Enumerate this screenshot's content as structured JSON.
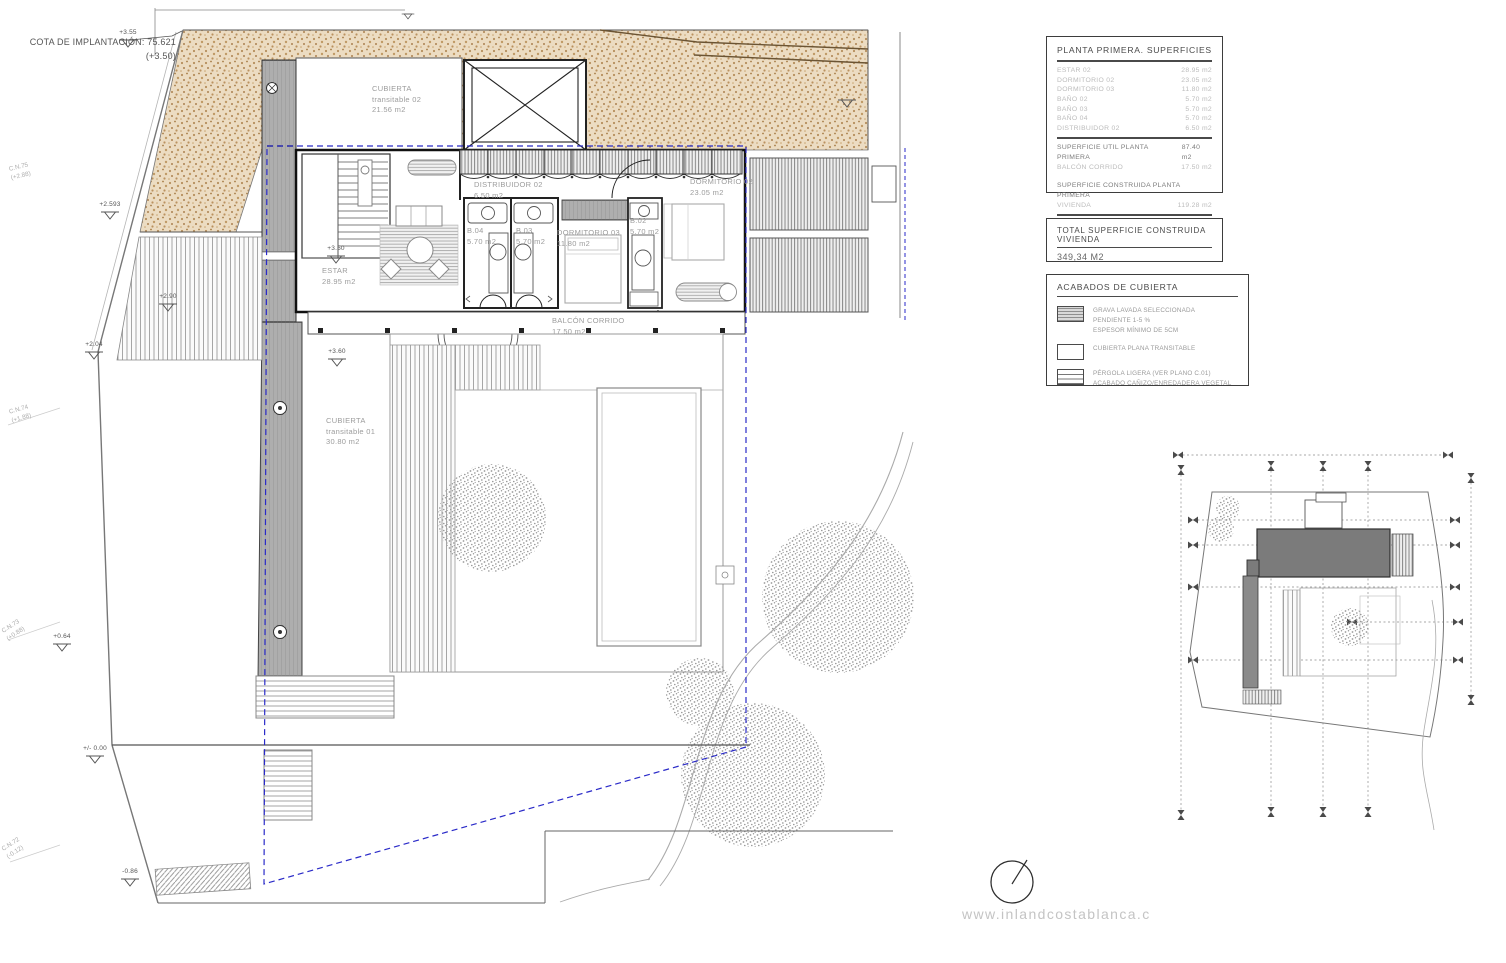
{
  "title_block": {
    "cota_line1": "COTA DE IMPLANTACIÓN: 75.621",
    "cota_line2": "(+3.50)"
  },
  "plan_labels": {
    "cubierta02": {
      "l1": "CUBIERTA",
      "l2": "transitable 02",
      "area": "21.56 m2"
    },
    "cubierta01": {
      "l1": "CUBIERTA",
      "l2": "transitable 01",
      "area": "30.80 m2"
    },
    "estar": {
      "l1": "ESTAR",
      "area": "28.95 m2"
    },
    "distribuidor02": {
      "l1": "DISTRIBUIDOR 02",
      "area": "6.50 m2"
    },
    "b04": {
      "l1": "B.04",
      "area": "5.70 m2"
    },
    "b03": {
      "l1": "B.03",
      "area": "5.70 m2"
    },
    "b02": {
      "l1": "B.02",
      "area": "5.70 m2"
    },
    "dormitorio03": {
      "l1": "DORMITORIO 03",
      "area": "11.80 m2"
    },
    "dormitorio02": {
      "l1": "DORMITORIO 02",
      "area": "23.05 m2"
    },
    "balcon": {
      "l1": "BALCÓN CORRIDO",
      "area": "17.50 m2"
    }
  },
  "levels": {
    "l355": "+3.55",
    "l2593": "+2.593",
    "l290": "+2.90",
    "l204": "+2.04",
    "l350": "+3.50",
    "l360": "+3.60",
    "l064": "+0.64",
    "l000": "+/- 0.00",
    "lm086": "-0.86"
  },
  "contours": {
    "cn75": {
      "name": "C.N.75",
      "val": "(+2.88)"
    },
    "cn74": {
      "name": "C.N.74",
      "val": "(+1.88)"
    },
    "cn73": {
      "name": "C.N.73",
      "val": "(+0.88)"
    },
    "cn72": {
      "name": "C.N.72",
      "val": "(-0.12)"
    }
  },
  "superficies": {
    "title": "PLANTA PRIMERA. SUPERFICIES",
    "rows": [
      {
        "label": "ESTAR 02",
        "value": "28.95 m2"
      },
      {
        "label": "DORMITORIO 02",
        "value": "23.05 m2"
      },
      {
        "label": "DORMITORIO 03",
        "value": "11.80 m2"
      },
      {
        "label": "BAÑO 02",
        "value": "5.70 m2"
      },
      {
        "label": "BAÑO 03",
        "value": "5.70 m2"
      },
      {
        "label": "BAÑO 04",
        "value": "5.70 m2"
      },
      {
        "label": "DISTRIBUIDOR 02",
        "value": "6.50 m2"
      }
    ],
    "util": {
      "label": "SUPERFICIE UTIL PLANTA PRIMERA",
      "value": "87.40 m2"
    },
    "balcon": {
      "label": "BALCÓN CORRIDO",
      "value": "17.50 m2"
    },
    "construida_header": "SUPERFICIE CONSTRUIDA PLANTA PRIMERA",
    "vivienda": {
      "label": "VIVIENDA",
      "value": "119.28 m2"
    },
    "total": {
      "label": "TOTAL SUPERFICIE CONSTRUIDA P1",
      "value": "119.28 m2"
    }
  },
  "total_vivienda": {
    "title": "TOTAL SUPERFICIE CONSTRUIDA VIVIENDA",
    "value": "349,34 M2"
  },
  "acabados": {
    "title": "ACABADOS DE CUBIERTA",
    "items": [
      {
        "l1": "GRAVA LAVADA SELECCIONADA",
        "l2": "PENDIENTE 1-5 %",
        "l3": "ESPESOR MÍNIMO DE 5CM"
      },
      {
        "l1": "CUBIERTA PLANA TRANSITABLE"
      },
      {
        "l1": "PÉRGOLA LIGERA (VER PLANO C.01)",
        "l2": "ACABADO CAÑIZO/ENREDADERA VEGETAL"
      }
    ]
  },
  "watermark": "www.inlandcostablanca.c",
  "colors": {
    "terrain_base": "#ecdcc2",
    "terrain_speck": "#b08a58",
    "setback_blue": "#2a2ac8",
    "keyplan_building": "#7b7b7b"
  }
}
